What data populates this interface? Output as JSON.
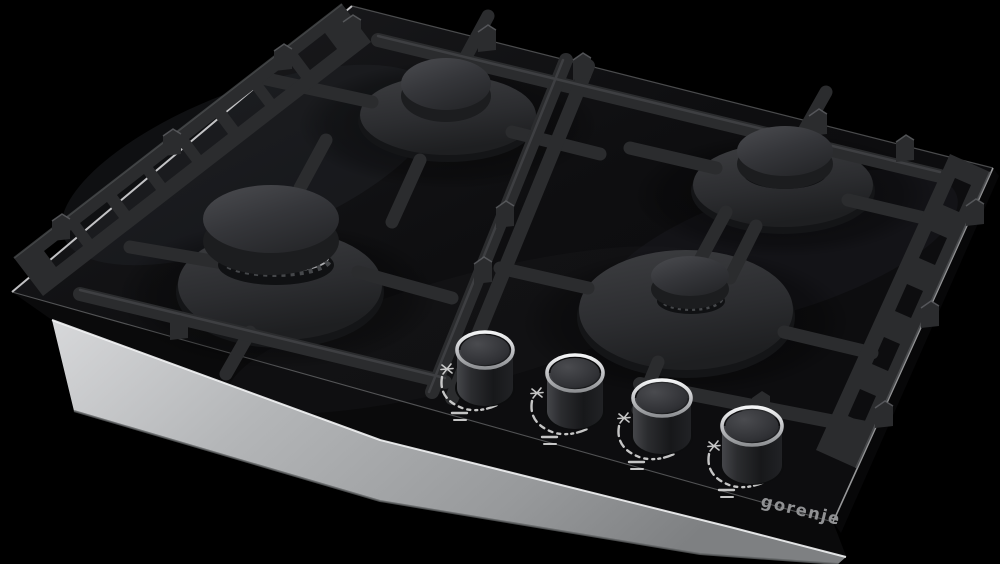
{
  "scene": {
    "background_color": "#000000",
    "alt": "Black built-in gas hob with four burners, cast-iron pan supports, four front control knobs and a stainless steel base tray"
  },
  "brand": {
    "logo_text": "gorenje"
  },
  "colors": {
    "background": "#000000",
    "glass": "#0d0d0f",
    "glass_highlight": "#dcdcde",
    "grid": "#2b2c2e",
    "grid_dark": "#1f2022",
    "burner_base": "#313235",
    "burner_cap": "#3a3b3e",
    "crown_silver": "#c9cacc",
    "steel_base": "#aeb0b2",
    "knob_body": "#232427",
    "knob_rim": "#cfd0d2",
    "markings": "#d9d9d9",
    "logo": "#909193"
  },
  "burners": [
    {
      "id": "burner-rear-left",
      "cap_finish": "matte-black",
      "crown_finish": "silver"
    },
    {
      "id": "burner-rear-right",
      "cap_finish": "matte-black",
      "crown_finish": "silver"
    },
    {
      "id": "burner-front-left",
      "cap_finish": "matte-black",
      "crown_finish": "silver"
    },
    {
      "id": "burner-front-right",
      "cap_finish": "matte-black",
      "crown_finish": "silver"
    }
  ],
  "knobs": [
    {
      "id": "knob-1",
      "symbols": [
        "spark-icon",
        "flame-scale-arc",
        "flame-min-max-lines"
      ]
    },
    {
      "id": "knob-2",
      "symbols": [
        "spark-icon",
        "flame-scale-arc",
        "flame-min-max-lines"
      ]
    },
    {
      "id": "knob-3",
      "symbols": [
        "spark-icon",
        "flame-scale-arc",
        "flame-min-max-lines"
      ]
    },
    {
      "id": "knob-4",
      "symbols": [
        "spark-icon",
        "flame-scale-arc",
        "flame-min-max-lines"
      ]
    }
  ]
}
